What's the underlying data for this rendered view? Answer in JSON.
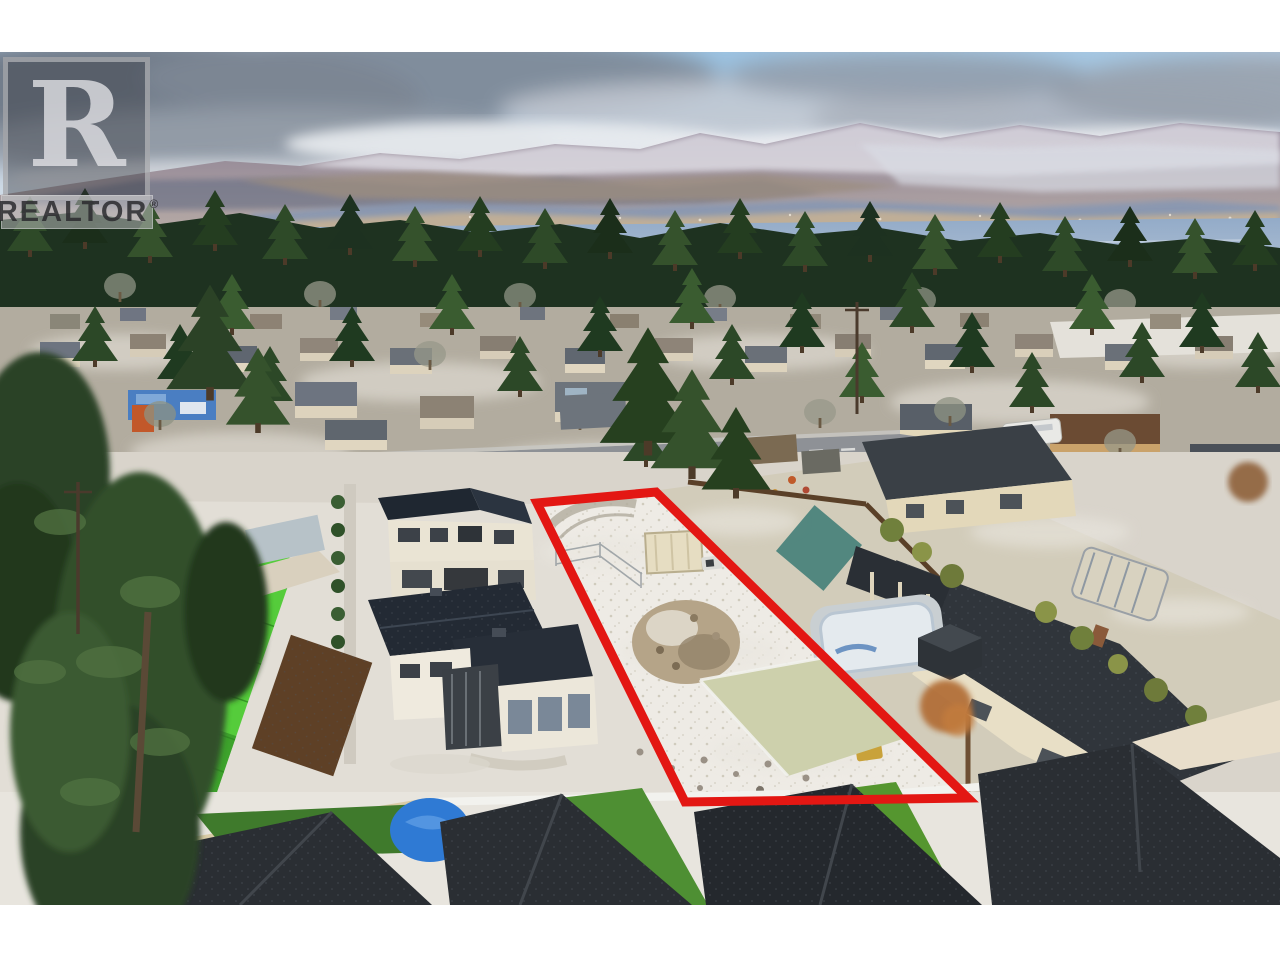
{
  "watermark": {
    "logo_letter": "R",
    "wordmark": "REALTOR",
    "registered_symbol": "®"
  },
  "boundary": {
    "label": "vacant-lot-property-outline",
    "color": "#e31713",
    "stroke_width": 9,
    "points_photo": [
      [
        537,
        451
      ],
      [
        656,
        440
      ],
      [
        968,
        746
      ],
      [
        685,
        750
      ]
    ]
  },
  "scene": {
    "description": "Winter aerial drone photo: vacant development lot outlined in red among suburban homes, evergreen forest, lake and snow-dusted mountains",
    "palette": {
      "sky_blue": "#9cc3e2",
      "cloud_grey": "#7d8795",
      "cloud_white": "#e9ecef",
      "mountain": "#8d8298",
      "mountain_snow": "#e6e5ec",
      "lake": "#8fa8c6",
      "far_shore": "#bfae97",
      "forest_green": "#24381f",
      "snow_ground": "#edeae4",
      "road_grey": "#8e9196",
      "modern_roof": "#232a34",
      "townhouse_roof": "#2a2e33",
      "lawn_green": "#4e8f33",
      "bright_roof_green": "#55cc3b",
      "beige_wall": "#e3d8ba",
      "pool_ice": "#e4eaee",
      "tarp_blue": "#2f7ad4",
      "boundary_red": "#e31713"
    }
  }
}
